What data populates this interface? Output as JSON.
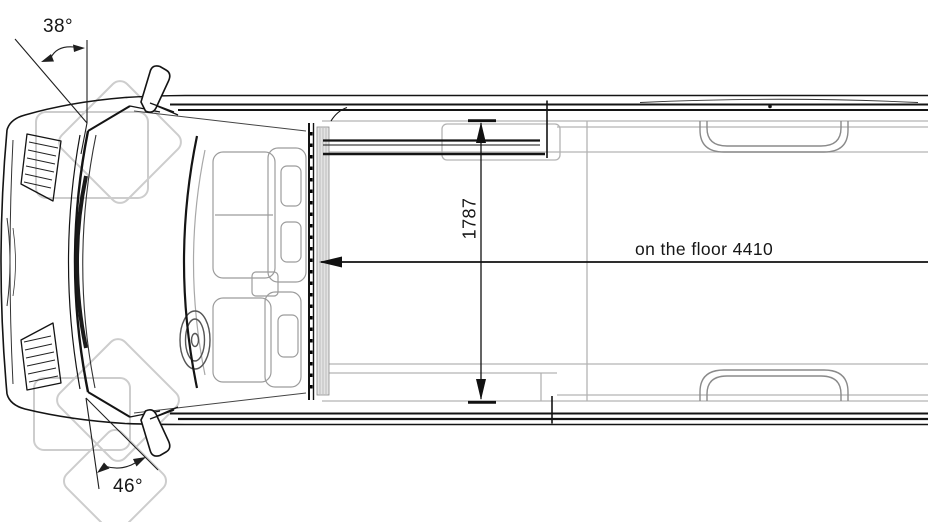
{
  "page": {
    "background": "#ffffff",
    "description": "Technical top-view dimension drawing of a van (cab with seats at front left, open cargo floor to the right), with door-opening angle annotations and interior floor dimensions"
  },
  "drawing": {
    "type": "vehicle-top-view-dimension-diagram",
    "line_color": "#141414",
    "light_line_color": "#b3b3b3",
    "watermark_color": "#cdcdcd"
  },
  "labels": {
    "angle_top": "38°",
    "angle_bottom": "46°",
    "interior_width": "1787",
    "floor_length": "on the floor 4410"
  }
}
